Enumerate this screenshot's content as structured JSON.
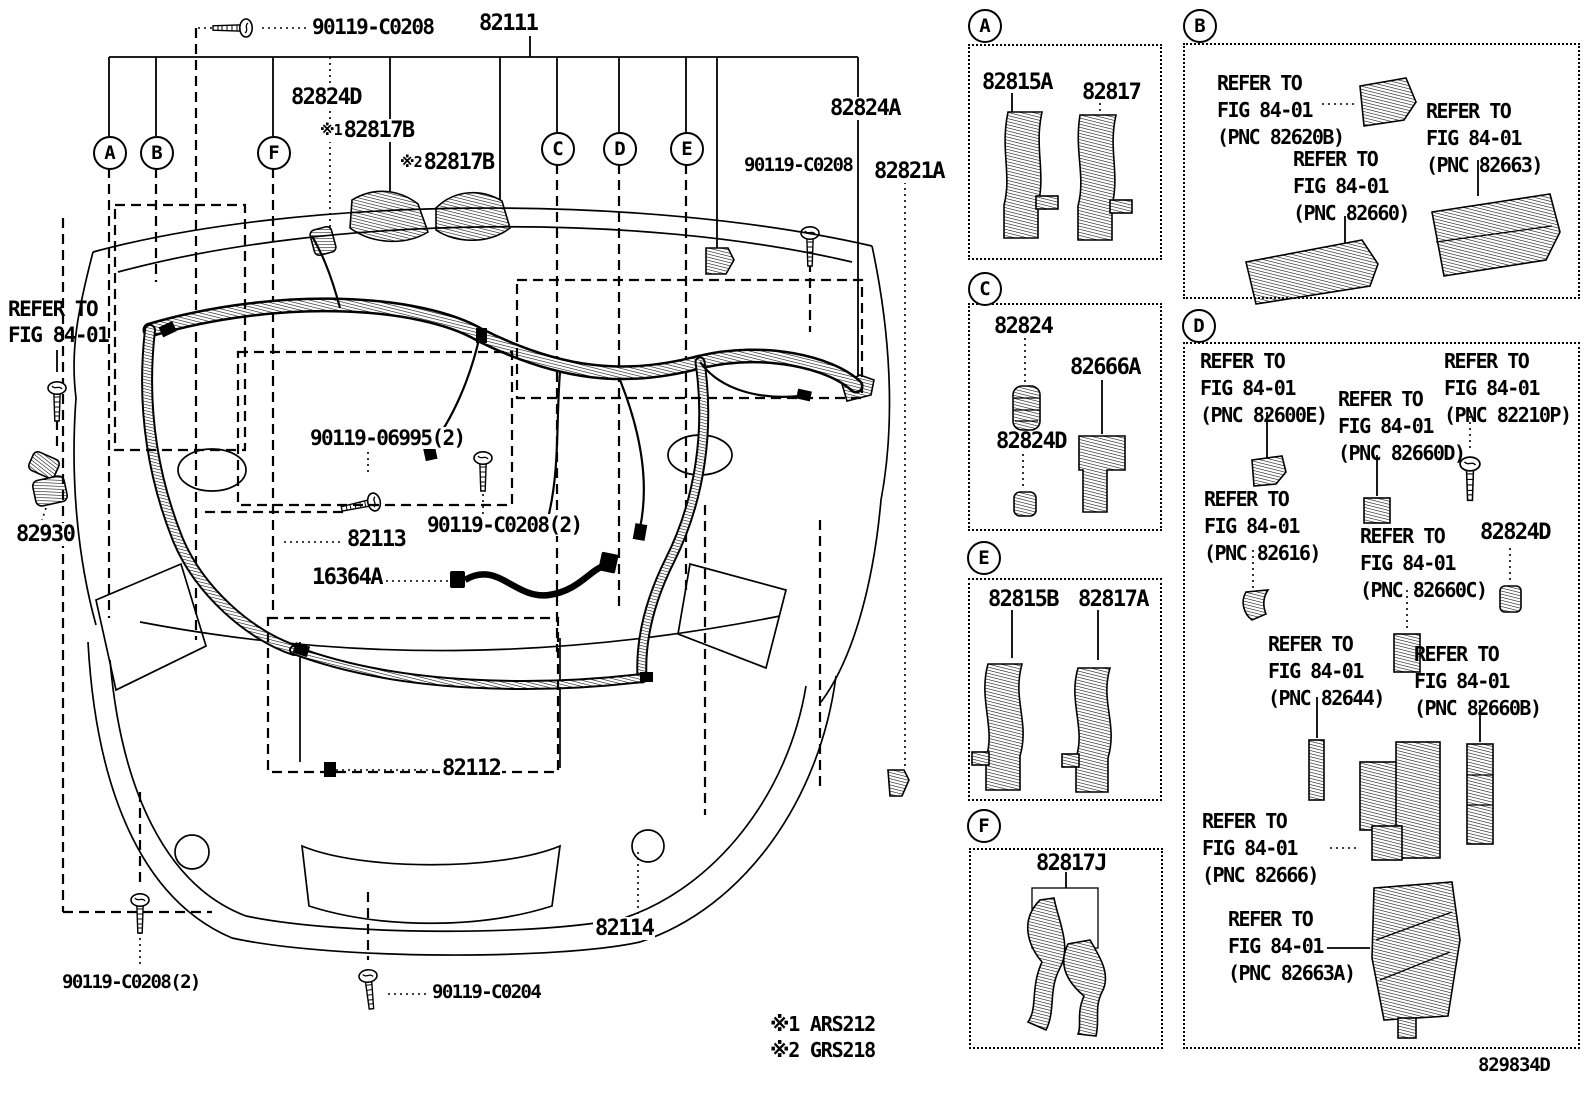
{
  "main": {
    "callouts": [
      "A",
      "B",
      "F",
      "C",
      "D",
      "E"
    ],
    "labels": {
      "bolt_top_left": "90119-C0208",
      "harness_main": "82111",
      "grommet_top": "82824D",
      "protector_1_prefix": "※1",
      "protector_1": "82817B",
      "protector_2_prefix": "※2",
      "protector_2": "82817B",
      "bracket_right": "82824A",
      "bolt_right": "90119-C0208",
      "wire_right": "82821A",
      "refer_l1": "REFER TO",
      "refer_l2": "FIG 84-01",
      "sensor_left": "82930",
      "screw_mid": "90119-06995(2)",
      "wire_mid": "82113",
      "bolt_mid": "90119-C0208(2)",
      "wire_pigtail": "16364A",
      "wire_lower": "82112",
      "wire_bumper": "82114",
      "bolt_bottom_left": "90119-C0208(2)",
      "bolt_bottom_center": "90119-C0204"
    }
  },
  "panels": {
    "a": {
      "letter": "A",
      "parts": [
        "82815A",
        "82817"
      ]
    },
    "b": {
      "letter": "B",
      "refs": [
        [
          "REFER TO",
          "FIG 84-01",
          "(PNC 82620B)"
        ],
        [
          "REFER TO",
          "FIG 84-01",
          "(PNC 82663)"
        ],
        [
          "REFER TO",
          "FIG 84-01",
          "(PNC 82660)"
        ]
      ]
    },
    "c": {
      "letter": "C",
      "parts": [
        "82824",
        "82666A",
        "82824D"
      ]
    },
    "d": {
      "letter": "D",
      "part_label": "82824D",
      "refs": [
        [
          "REFER TO",
          "FIG 84-01",
          "(PNC 82600E)"
        ],
        [
          "REFER TO",
          "FIG 84-01",
          "(PNC 82660D)"
        ],
        [
          "REFER TO",
          "FIG 84-01",
          "(PNC 82210P)"
        ],
        [
          "REFER TO",
          "FIG 84-01",
          "(PNC 82616)"
        ],
        [
          "REFER TO",
          "FIG 84-01",
          "(PNC 82660C)"
        ],
        [
          "REFER TO",
          "FIG 84-01",
          "(PNC 82644)"
        ],
        [
          "REFER TO",
          "FIG 84-01",
          "(PNC 82660B)"
        ],
        [
          "REFER TO",
          "FIG 84-01",
          "(PNC 82666)"
        ],
        [
          "REFER TO",
          "FIG 84-01",
          "(PNC 82663A)"
        ]
      ]
    },
    "e": {
      "letter": "E",
      "parts": [
        "82815B",
        "82817A"
      ]
    },
    "f": {
      "letter": "F",
      "parts": [
        "82817J"
      ]
    }
  },
  "footer": {
    "note1": "※1 ARS212",
    "note2": "※2 GRS218",
    "drawing_number": "829834D"
  }
}
